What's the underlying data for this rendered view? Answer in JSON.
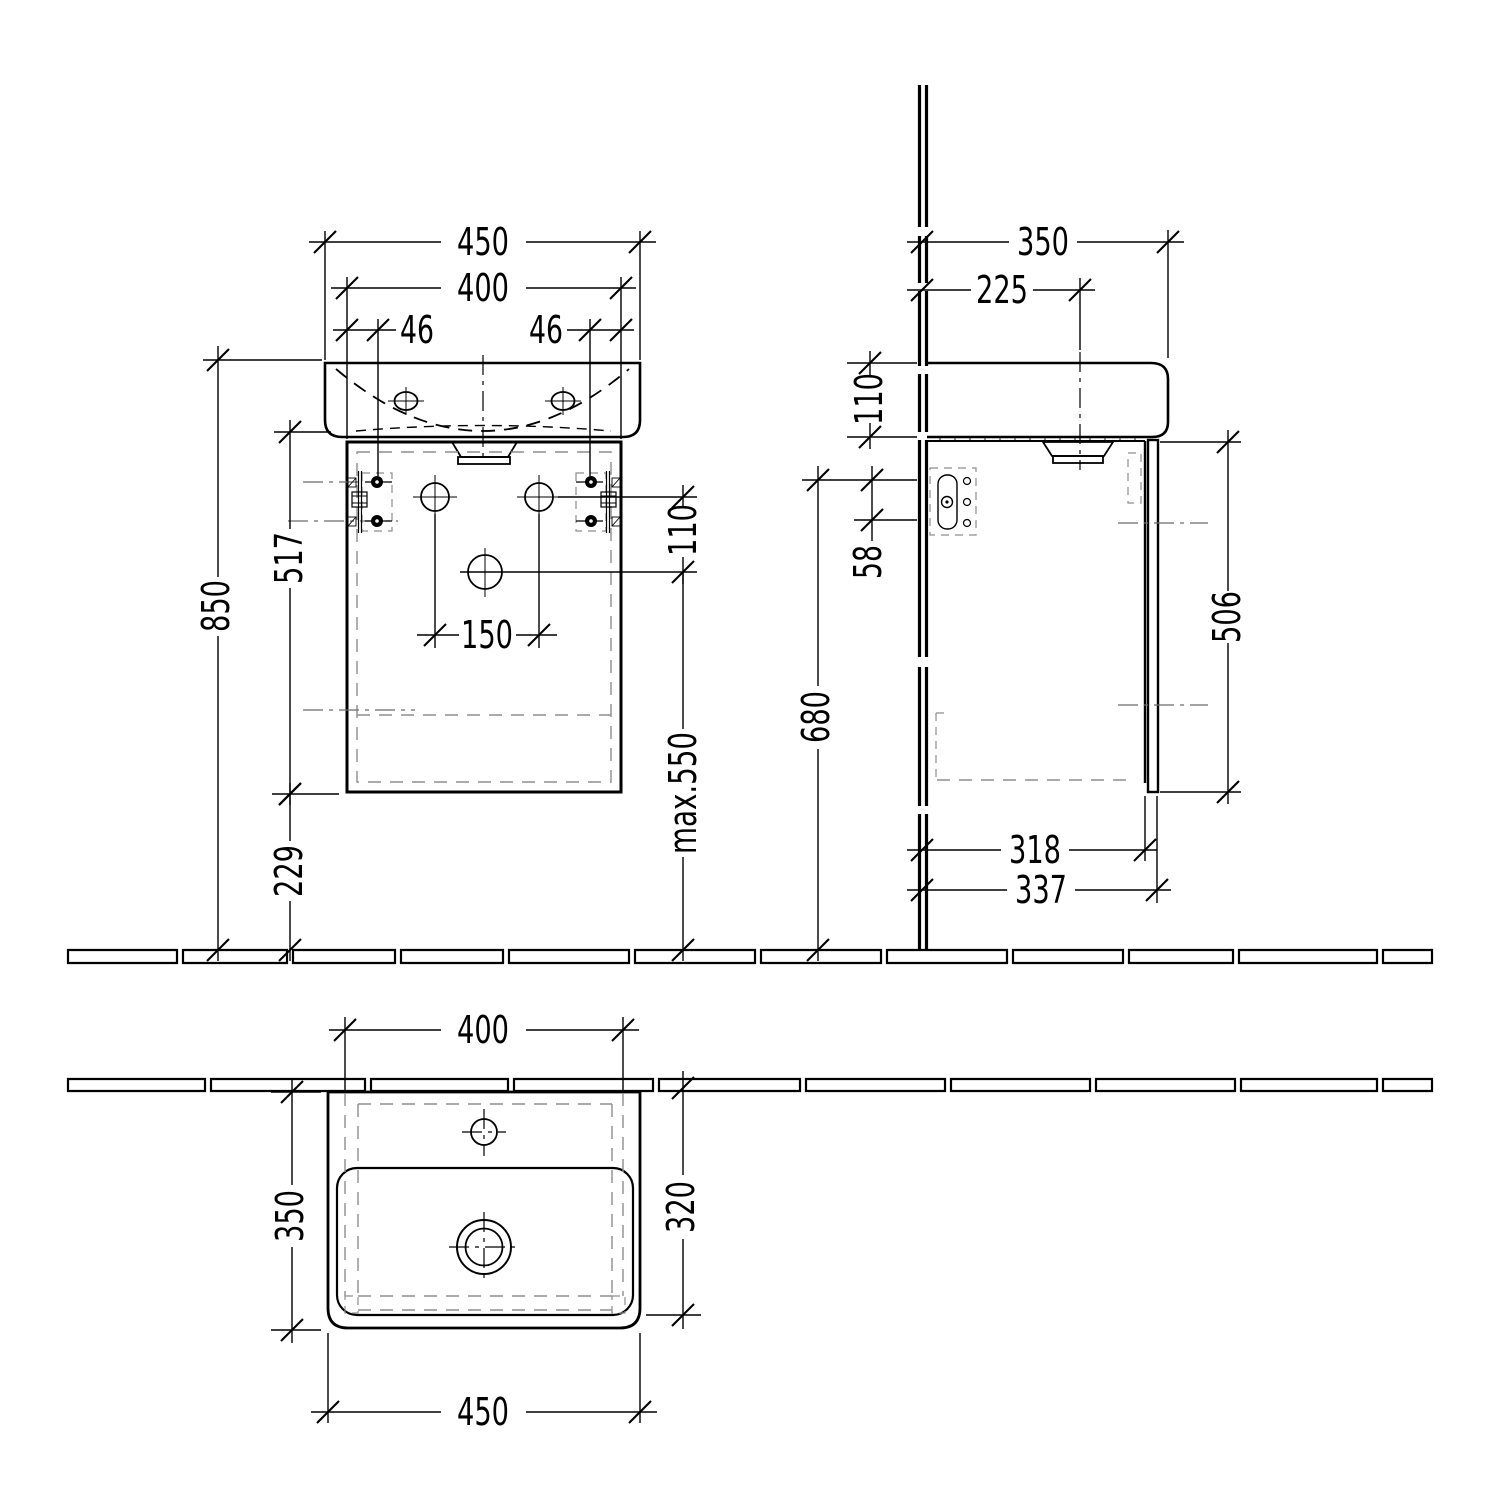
{
  "document": {
    "title": "Wall-hung washbasin with vanity unit - dimensional drawing"
  },
  "colors": {
    "line": "#000000",
    "hidden_line": "#8d8d8d",
    "background": "#ffffff"
  },
  "views": {
    "front": {
      "name": "front view",
      "dims": {
        "basin_width": "450",
        "cabinet_width": "400",
        "bracket_offset_left": "46",
        "bracket_offset_right": "46",
        "height_total": "850",
        "cabinet_height": "517",
        "floor_clearance": "229",
        "tap_holes_spacing": "150",
        "drain_offset": "110",
        "trap_max": "max.550"
      }
    },
    "side": {
      "name": "side view",
      "dims": {
        "basin_depth": "350",
        "drain_from_wall": "225",
        "basin_height": "110",
        "bracket_holes_spacing": "58",
        "bracket_height_from_floor": "680",
        "door_height": "506",
        "cabinet_body_depth": "318",
        "overall_depth": "337"
      }
    },
    "top": {
      "name": "top view",
      "dims": {
        "cabinet_width": "400",
        "basin_depth": "350",
        "bowl_front_depth": "320",
        "basin_width": "450"
      }
    }
  }
}
